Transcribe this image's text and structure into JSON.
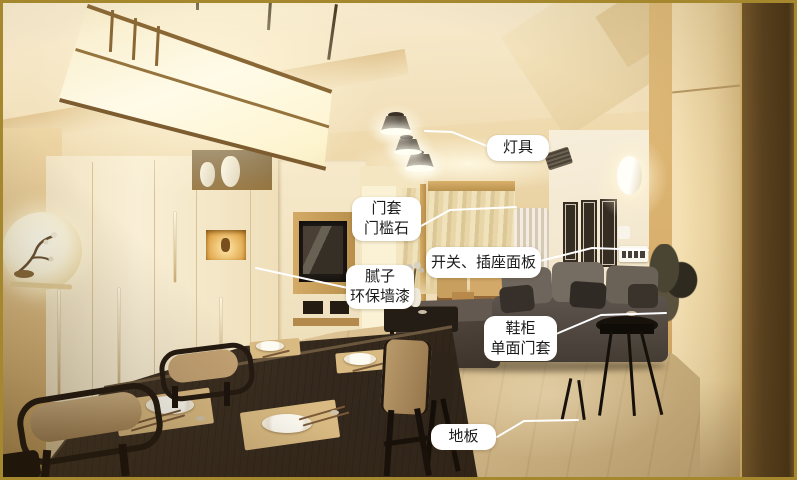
{
  "annotations": [
    {
      "id": "lamp",
      "lines": [
        "灯具"
      ]
    },
    {
      "id": "door-casing",
      "lines": [
        "门套",
        "门槛石"
      ]
    },
    {
      "id": "switch-socket-panel",
      "lines": [
        "开关、插座面板"
      ]
    },
    {
      "id": "putty-eco-paint",
      "lines": [
        "腻子",
        "环保墙漆"
      ]
    },
    {
      "id": "shoe-cabinet",
      "lines": [
        "鞋柜",
        "单面门套"
      ]
    },
    {
      "id": "floor",
      "lines": [
        "地板"
      ]
    }
  ],
  "palette": {
    "callout_bg": "#ffffff",
    "callout_text": "#1c1c1c",
    "leader_line": "#ffffff",
    "frame_border": "#a5872e",
    "wall_warm": "#e8cd96",
    "cabinet_cream": "#f4e8cb",
    "floor_wood": "#dcc493",
    "sofa_gray": "#58504a",
    "table_dark": "#33291e",
    "wood_column_dark": "#5a421f"
  }
}
